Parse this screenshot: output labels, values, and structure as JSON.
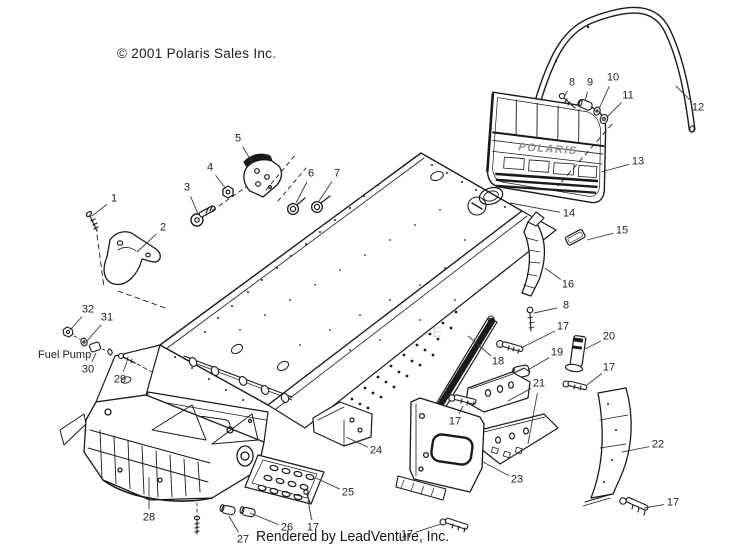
{
  "header": {
    "copyright": "© 2001 Polaris Sales Inc."
  },
  "footer": {
    "rendered_by": "Rendered by LeadVenture, Inc."
  },
  "watermark": {
    "text": "LEADVENTURE",
    "color": "#e3e3e3"
  },
  "diagram": {
    "description": "Exploded parts view of snowmobile chassis / tunnel assembly",
    "line_color": "#1a1a1a",
    "flap_logo": "POLARIS",
    "fuel_pump_label": "Fuel Pump",
    "callouts": [
      {
        "label": "1",
        "x": 114,
        "y": 199,
        "targets": [
          [
            92,
            216
          ]
        ]
      },
      {
        "label": "2",
        "x": 163,
        "y": 228,
        "targets": [
          [
            137,
            252
          ]
        ]
      },
      {
        "label": "3",
        "x": 187,
        "y": 188,
        "targets": [
          [
            198,
            214
          ]
        ]
      },
      {
        "label": "4",
        "x": 210,
        "y": 168,
        "targets": [
          [
            226,
            189
          ]
        ]
      },
      {
        "label": "5",
        "x": 238,
        "y": 139,
        "targets": [
          [
            252,
            162
          ]
        ]
      },
      {
        "label": "6",
        "x": 311,
        "y": 174,
        "targets": [
          [
            296,
            203
          ]
        ]
      },
      {
        "label": "7",
        "x": 337,
        "y": 174,
        "targets": [
          [
            319,
            201
          ]
        ]
      },
      {
        "label": "8",
        "x": 572,
        "y": 83,
        "targets": [
          [
            564,
            97
          ]
        ]
      },
      {
        "label": "9",
        "x": 590,
        "y": 83,
        "targets": [
          [
            585,
            101
          ]
        ]
      },
      {
        "label": "10",
        "x": 613,
        "y": 78,
        "targets": [
          [
            599,
            109
          ]
        ]
      },
      {
        "label": "11",
        "x": 628,
        "y": 96,
        "targets": [
          [
            607,
            117
          ]
        ]
      },
      {
        "label": "12",
        "x": 698,
        "y": 108,
        "targets": [
          [
            676,
            86
          ]
        ]
      },
      {
        "label": "13",
        "x": 638,
        "y": 162,
        "targets": [
          [
            601,
            172
          ]
        ]
      },
      {
        "label": "14",
        "x": 569,
        "y": 214,
        "targets": [
          [
            510,
            203
          ]
        ]
      },
      {
        "label": "15",
        "x": 622,
        "y": 231,
        "targets": [
          [
            587,
            240
          ]
        ]
      },
      {
        "label": "16",
        "x": 568,
        "y": 285,
        "targets": [
          [
            545,
            268
          ]
        ]
      },
      {
        "label": "8",
        "x": 566,
        "y": 306,
        "targets": [
          [
            534,
            313
          ]
        ]
      },
      {
        "label": "17",
        "x": 563,
        "y": 327,
        "targets": [
          [
            521,
            348
          ]
        ]
      },
      {
        "label": "18",
        "x": 498,
        "y": 362,
        "targets": [
          [
            468,
            336
          ]
        ]
      },
      {
        "label": "19",
        "x": 557,
        "y": 353,
        "targets": [
          [
            528,
            370
          ]
        ]
      },
      {
        "label": "20",
        "x": 609,
        "y": 337,
        "targets": [
          [
            585,
            349
          ]
        ]
      },
      {
        "label": "17",
        "x": 609,
        "y": 368,
        "targets": [
          [
            587,
            385
          ]
        ]
      },
      {
        "label": "21",
        "x": 539,
        "y": 384,
        "targets": [
          [
            508,
            401
          ],
          [
            528,
            444
          ]
        ]
      },
      {
        "label": "17",
        "x": 455,
        "y": 422,
        "targets": [
          [
            463,
            406
          ]
        ]
      },
      {
        "label": "22",
        "x": 658,
        "y": 445,
        "targets": [
          [
            622,
            452
          ]
        ]
      },
      {
        "label": "23",
        "x": 517,
        "y": 480,
        "targets": [
          [
            483,
            462
          ]
        ]
      },
      {
        "label": "24",
        "x": 376,
        "y": 451,
        "targets": [
          [
            346,
            437
          ]
        ]
      },
      {
        "label": "25",
        "x": 348,
        "y": 493,
        "targets": [
          [
            316,
            478
          ]
        ]
      },
      {
        "label": "26",
        "x": 287,
        "y": 528,
        "targets": [
          [
            250,
            513
          ]
        ]
      },
      {
        "label": "17",
        "x": 313,
        "y": 528,
        "targets": [
          [
            308,
            500
          ]
        ]
      },
      {
        "label": "27",
        "x": 243,
        "y": 540,
        "targets": [
          [
            229,
            516
          ]
        ]
      },
      {
        "label": "28",
        "x": 149,
        "y": 518,
        "targets": [
          [
            149,
            477
          ]
        ]
      },
      {
        "label": "29",
        "x": 120,
        "y": 380,
        "targets": [
          [
            127,
            362
          ]
        ]
      },
      {
        "label": "30",
        "x": 88,
        "y": 370,
        "targets": [
          [
            96,
            353
          ]
        ]
      },
      {
        "label": "31",
        "x": 107,
        "y": 318,
        "targets": [
          [
            87,
            341
          ]
        ]
      },
      {
        "label": "32",
        "x": 88,
        "y": 310,
        "targets": [
          [
            70,
            330
          ]
        ]
      },
      {
        "label": "17",
        "x": 673,
        "y": 503,
        "targets": [
          [
            644,
            508
          ]
        ]
      },
      {
        "label": "17",
        "x": 407,
        "y": 535,
        "targets": [
          [
            441,
            524
          ]
        ]
      }
    ]
  }
}
